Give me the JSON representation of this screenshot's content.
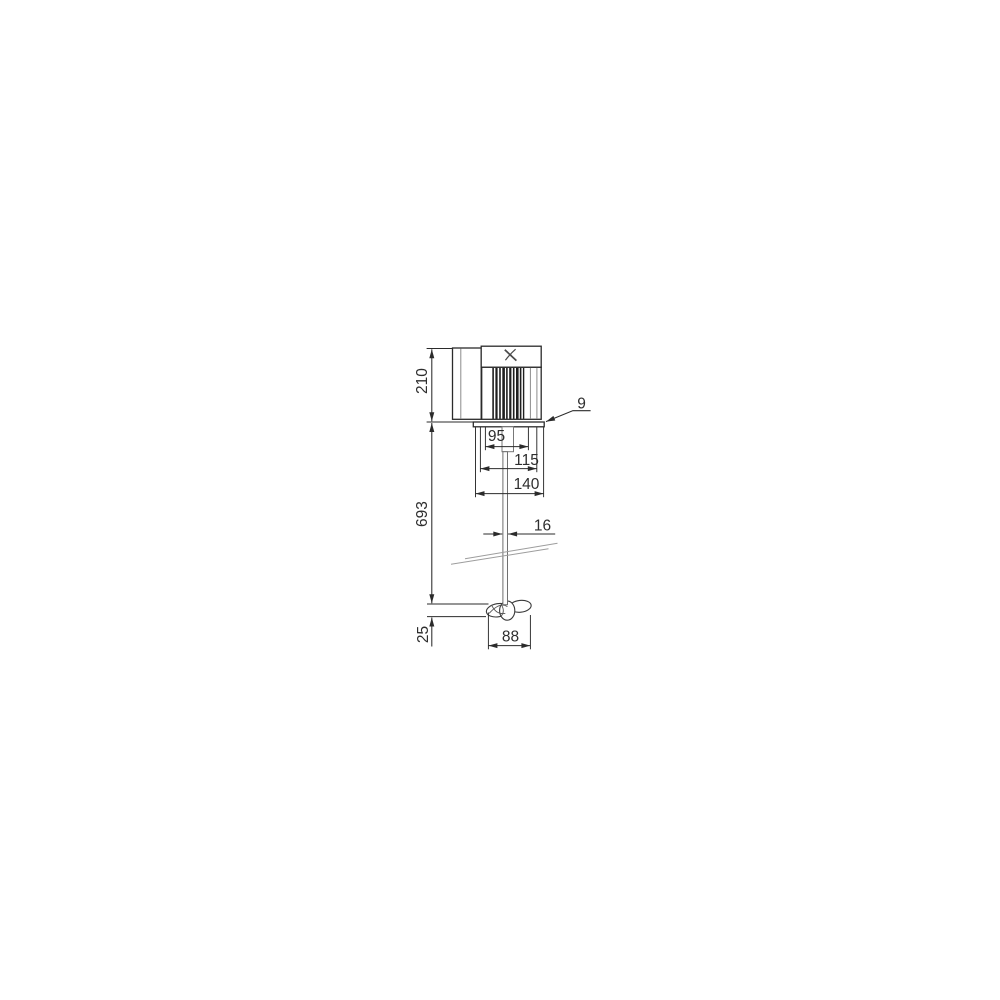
{
  "dims": {
    "motor_height": "210",
    "flange_thickness": "9",
    "flange_pilot_width": "95",
    "bolt_circle_width": "115",
    "flange_width": "140",
    "shaft_length": "693",
    "shaft_diameter": "16",
    "propeller_height": "25",
    "propeller_diameter": "88"
  }
}
